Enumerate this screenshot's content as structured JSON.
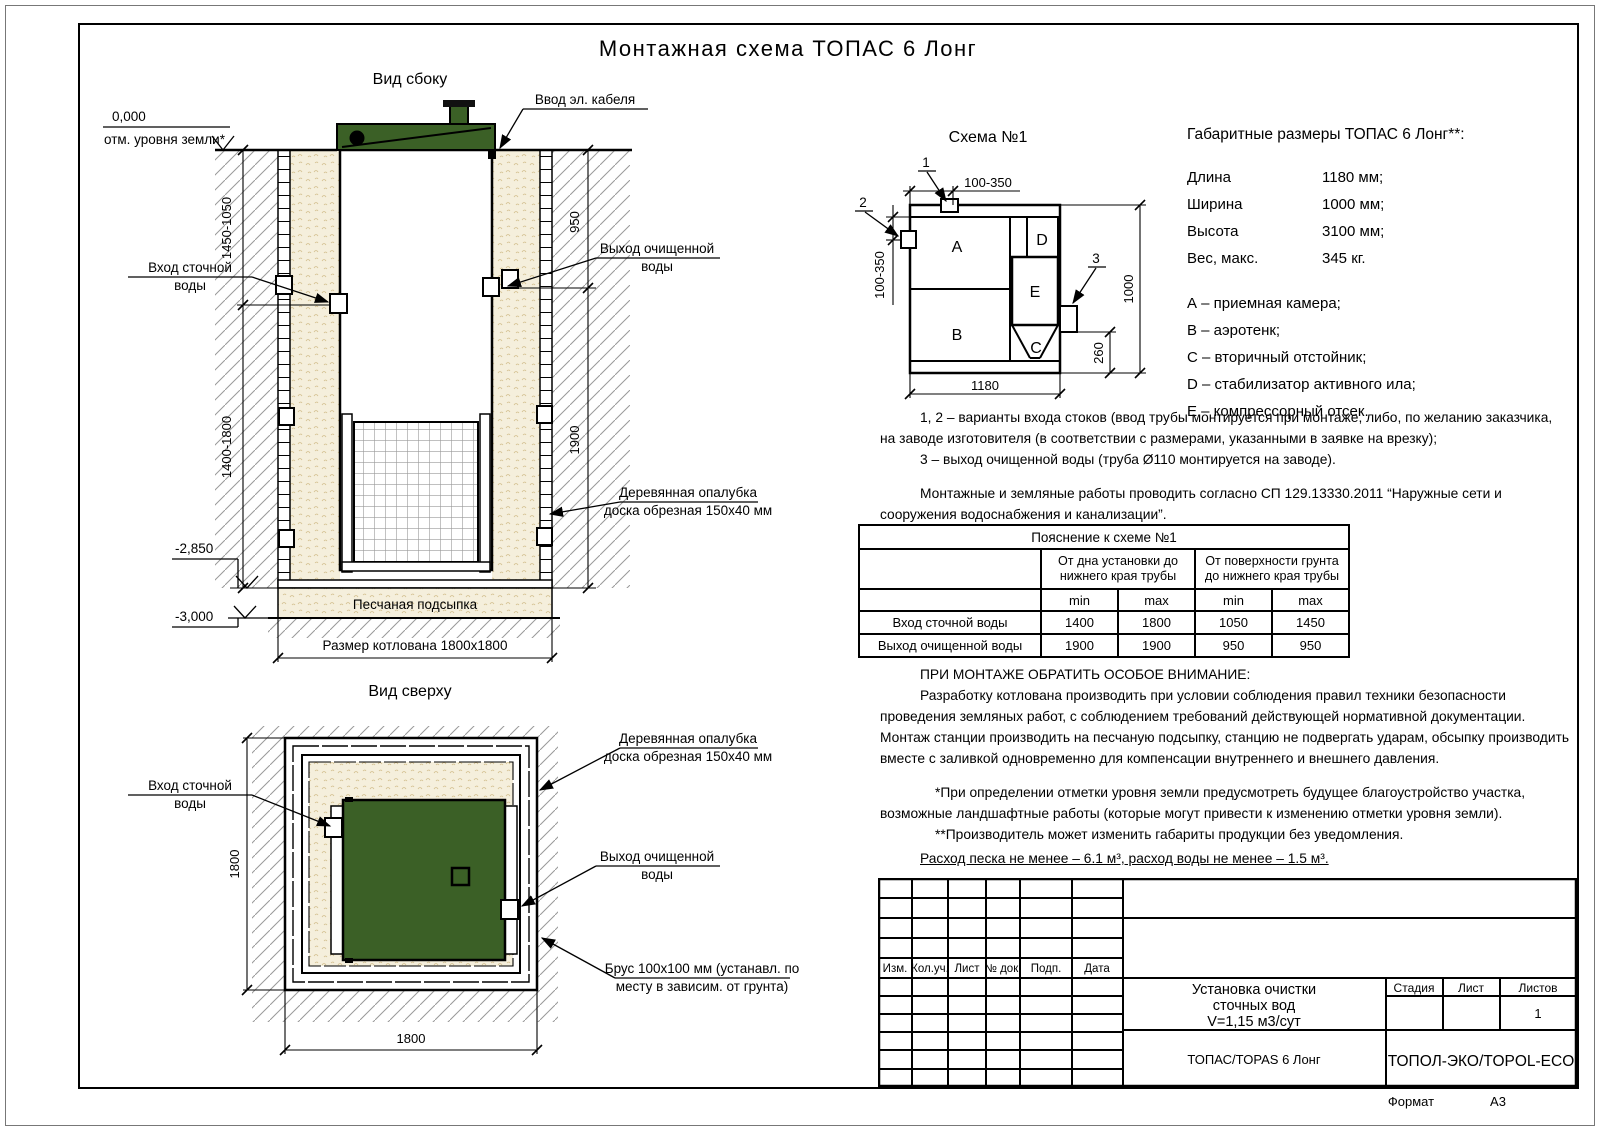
{
  "title": "Монтажная схема ТОПАС 6 Лонг",
  "colors": {
    "tank_green": "#3b6026",
    "sand": "#f5efdc",
    "hatch": "#999999",
    "line": "#000000"
  },
  "side": {
    "title": "Вид сбоку",
    "cable": "Ввод эл. кабеля",
    "ground_value": "0,000",
    "ground_caption": "отм. уровня земли*",
    "inlet1": "Вход сточной",
    "inlet2": "воды",
    "outlet1": "Выход очищенной",
    "outlet2": "воды",
    "formwork1": "Деревянная опалубка",
    "formwork2": "доска обрезная 150х40 мм",
    "sand_bed": "Песчаная подсыпка",
    "lvl285": "-2,850",
    "lvl300": "-3,000",
    "pit": "Размер котлована 1800х1800",
    "dim_left_top": "1450-1050",
    "dim_left_bot": "1400-1800",
    "dim_right_top": "950",
    "dim_right_bot": "1900"
  },
  "top": {
    "title": "Вид сверху",
    "inlet1": "Вход сточной",
    "inlet2": "воды",
    "formwork1": "Деревянная опалубка",
    "formwork2": "доска обрезная 150х40 мм",
    "outlet1": "Выход очищенной",
    "outlet2": "воды",
    "beam1": "Брус 100х100 мм (устанавл. по",
    "beam2": "месту в зависим. от грунта)",
    "dim_side": "1800",
    "dim_bottom": "1800"
  },
  "schema": {
    "title": "Схема №1",
    "a": "A",
    "b": "B",
    "c": "C",
    "d": "D",
    "e": "E",
    "c1": "1",
    "c2": "2",
    "c3": "3",
    "dim_top": "100-350",
    "dim_left": "100-350",
    "dim_bottom": "1180",
    "dim_right": "1000",
    "dim_outlet": "260"
  },
  "specs": {
    "title": "Габаритные размеры ТОПАС 6 Лонг**:",
    "rows": [
      [
        "Длина",
        "1180 мм;"
      ],
      [
        "Ширина",
        "1000 мм;"
      ],
      [
        "Высота",
        "3100 мм;"
      ],
      [
        "Вес, макс.",
        "345 кг."
      ]
    ],
    "legend": [
      "А – приемная камера;",
      "В – аэротенк;",
      "С – вторичный отстойник;",
      "D – стабилизатор активного ила;",
      "Е – компрессорный отсек."
    ]
  },
  "notes": {
    "n1": "1, 2 – варианты входа  стоков (ввод трубы монтируется при монтаже, либо, по желанию заказчика, на заводе изготовителя (в соответствии с размерами, указанными в заявке на врезку);",
    "n2": "3 – выход очищенной воды (труба Ø110 монтируется на заводе).",
    "sp": "Монтажные и земляные работы проводить согласно СП 129.13330.2011 “Наружные сети и сооружения водоснабжения и канализации”."
  },
  "table": {
    "title": "Пояснение к схеме №1",
    "g1": "От дна установки до нижнего края трубы",
    "g2": "От поверхности грунта до нижнего края трубы",
    "min1": "min",
    "max1": "max",
    "min2": "min",
    "max2": "max",
    "rows": [
      [
        "Вход сточной воды",
        "1400",
        "1800",
        "1050",
        "1450"
      ],
      [
        "Выход очищенной воды",
        "1900",
        "1900",
        "950",
        "950"
      ]
    ]
  },
  "attention": {
    "title": "ПРИ МОНТАЖЕ ОБРАТИТЬ ОСОБОЕ ВНИМАНИЕ:",
    "body": "Разработку котлована производить при условии соблюдения правил техники безопасности проведения земляных работ, с соблюдением требований действующей нормативной документации. Монтаж станции производить на песчаную подсыпку, станцию не подвергать ударам, обсыпку производить вместе с заливкой одновременно для компенсации внутреннего и внешнего давления."
  },
  "footnotes": {
    "f1": "*При определении отметки уровня земли предусмотреть будущее благоустройство участка, возможные ландшафтные работы (которые могут привести к изменению отметки уровня земли).",
    "f2": "**Производитель может изменить габариты продукции без уведомления.",
    "sand": "Расход песка не менее – 6.1 м³, расход воды не менее – 1.5 м³."
  },
  "stamp": {
    "c1": "Изм.",
    "c2": "Кол.уч.",
    "c3": "Лист",
    "c4": "№ док.",
    "c5": "Подп.",
    "c6": "Дата",
    "name1": "Установка очистки",
    "name2": "сточных вод",
    "name3": "V=1,15 м3/сут",
    "product": "ТОПАС/TOPAS 6 Лонг",
    "company": "ТОПОЛ-ЭКО/TOPOL-ECO",
    "stage": "Стадия",
    "sheet": "Лист",
    "sheets": "Листов",
    "sheets_val": "1",
    "format_label": "Формат",
    "format_val": "А3"
  }
}
